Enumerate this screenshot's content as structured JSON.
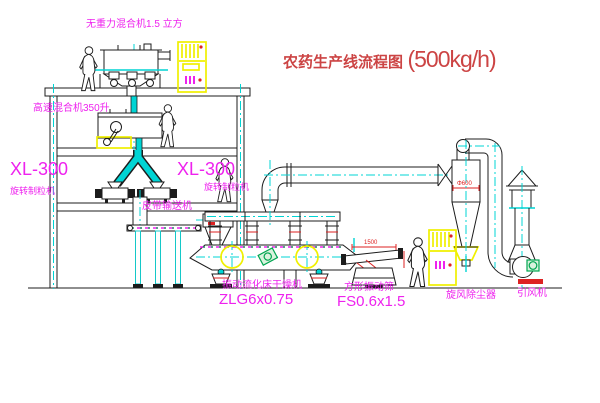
{
  "title": {
    "text": "农药生产线流程图",
    "capacity": "(500kg/h)"
  },
  "equipment_labels": {
    "gravity_mixer": "无重力混合机1.5 立方",
    "high_speed_mixer": "高速混合机350升",
    "granulator_left_model": "XL-300",
    "granulator_left_name": "旋转制粒机",
    "granulator_mid_model": "XL-300",
    "granulator_mid_name": "旋转制粒机",
    "belt_conveyor": "皮带输送机",
    "fluid_bed_dryer": "振动流化床干燥机",
    "fluid_bed_dryer_model": "ZLG6x0.75",
    "vibrating_sieve": "方形振动筛",
    "vibrating_sieve_model": "FS0.6x1.5",
    "cyclone": "旋风除尘器",
    "induced_draft_fan": "引风机"
  },
  "dimensions": {
    "sieve_length": "1500",
    "cyclone_diameter": "Φ600"
  },
  "colors": {
    "line": "#1c1c1c",
    "cyan": "#00d4d4",
    "magenta": "#ee22ee",
    "yellow": "#f0f000",
    "red": "#dd2222",
    "title_red": "#cc4444",
    "green": "#00a550"
  }
}
